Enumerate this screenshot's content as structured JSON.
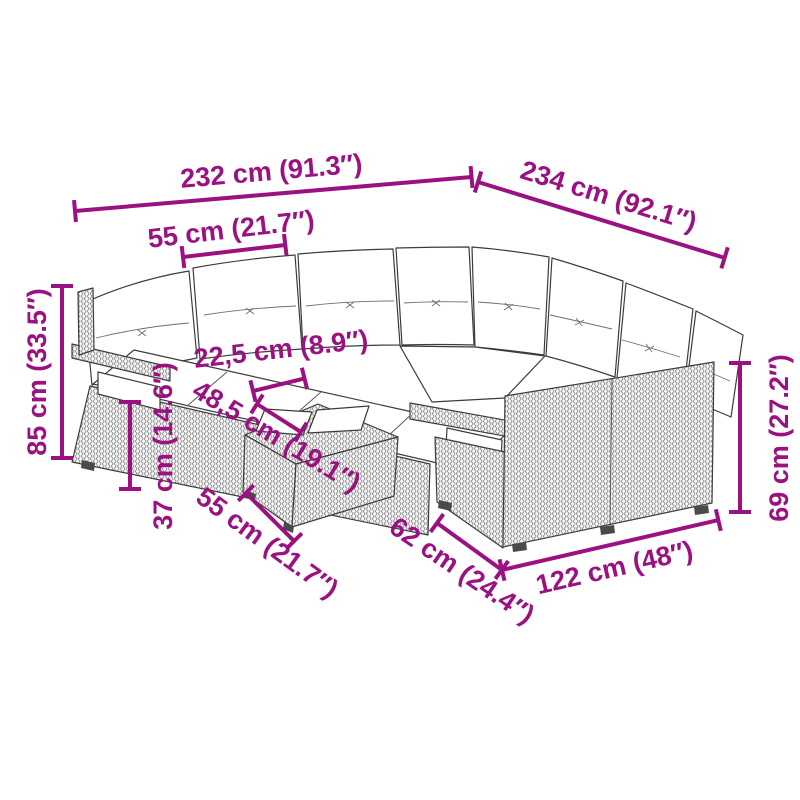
{
  "figure": {
    "type": "product-dimension-diagram",
    "subject": "modular-wicker-garden-sofa-set-with-cushions-and-table",
    "colors": {
      "dimension_accent": "#9B1181",
      "line_art_outline": "#3C3C3C",
      "wicker_texture": "#8A8A8A",
      "cushion_fill": "#FFFFFF",
      "background": "#FFFFFF"
    }
  },
  "dimensions": {
    "total_width": {
      "label": "232 cm (91.3″)"
    },
    "total_depth": {
      "label": "234 cm (92.1″)"
    },
    "seat_module_width": {
      "label": "55 cm (21.7″)"
    },
    "total_height": {
      "label": "85 cm (33.5″)"
    },
    "seat_height": {
      "label": "37 cm (14.6″)"
    },
    "tray_width": {
      "label": "22,5 cm (8.9″)"
    },
    "table_depth": {
      "label": "48,5 cm (19.1″)"
    },
    "table_width": {
      "label": "55 cm (21.7″)"
    },
    "section_depth": {
      "label": "62 cm (24.4″)"
    },
    "section_width": {
      "label": "122 cm (48″)"
    },
    "back_height": {
      "label": "69 cm (27.2″)"
    }
  }
}
